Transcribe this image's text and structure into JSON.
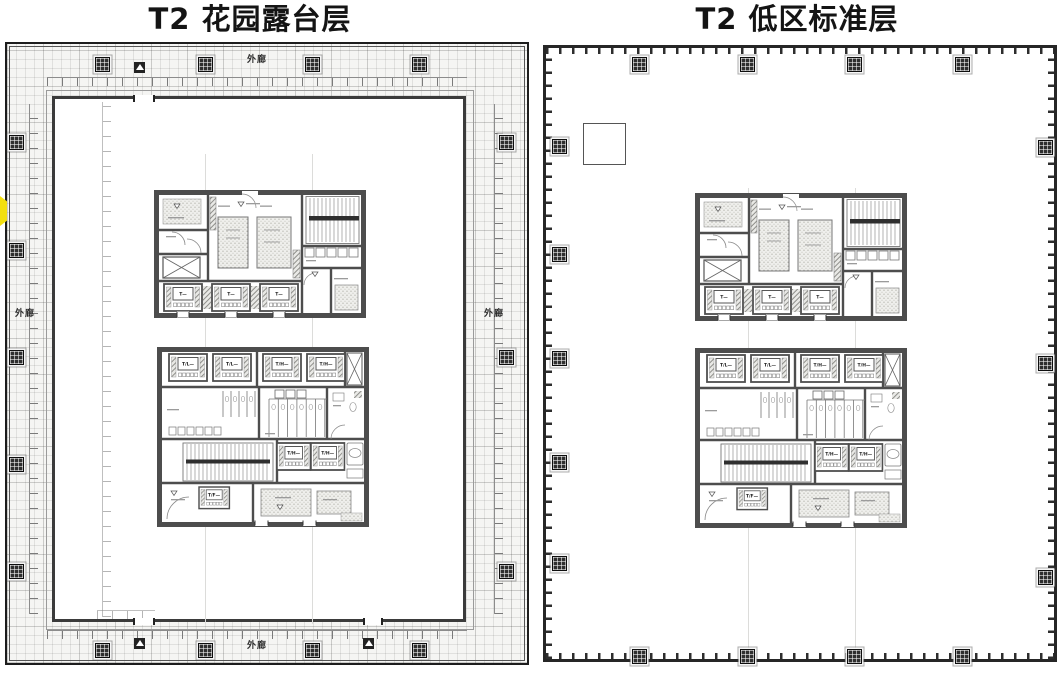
{
  "titles": {
    "left": "T2 花园露台层",
    "right": "T2 低区标准层"
  },
  "labels": {
    "corridor": "外廊",
    "lift_generic": "T—",
    "lift_low": "T/L—",
    "lift_high": "T/H—",
    "lift_fire": "T/F—"
  },
  "colors": {
    "highlight": "#f3df0e",
    "wall": "#4d4d4d",
    "outline": "#222222"
  }
}
